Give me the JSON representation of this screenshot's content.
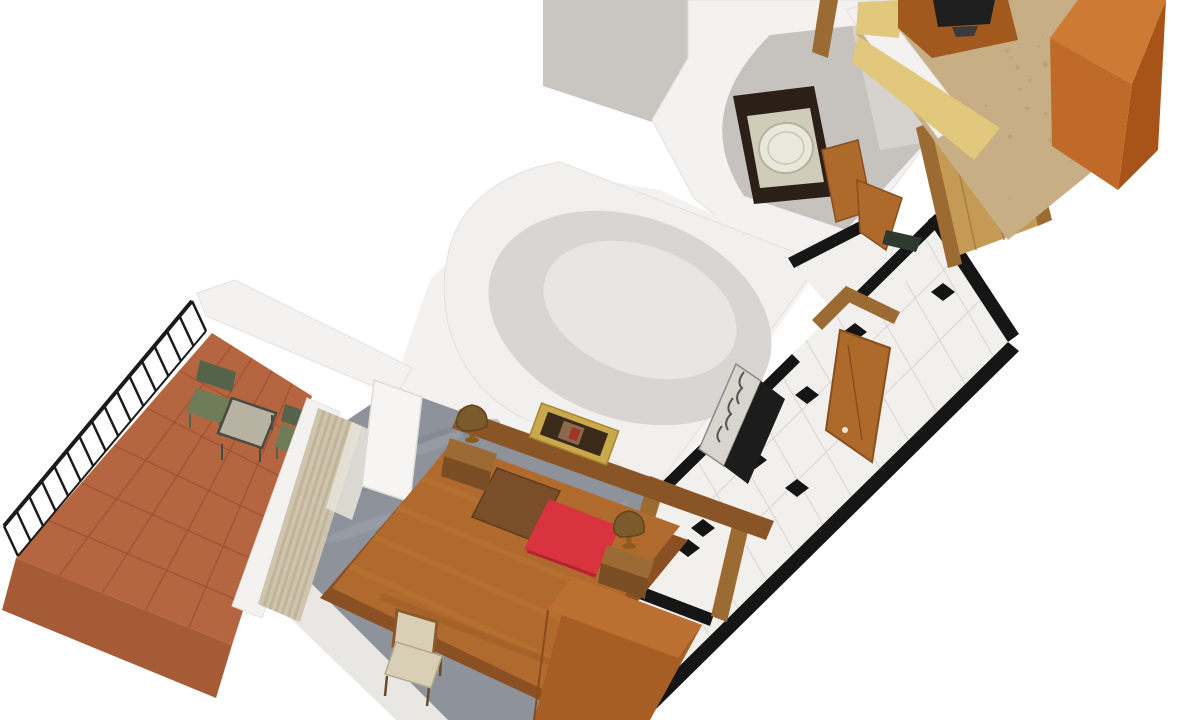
{
  "scene": {
    "kind": "3d-floorplan-render",
    "description": "Isometric 3D rendering of a hotel suite floor plan on a white background",
    "background": "#ffffff"
  },
  "palette": {
    "bg": "#ffffff",
    "roof_gray": "#c9c6c2",
    "wall_white": "#f3f2f0",
    "wall_stroke": "#e3e1de",
    "bathroom_wall": "#c6c3bf",
    "bath_wall_light": "#d6d3cf",
    "vanity_dark": "#2b1f18",
    "tub_rim": "#cfccba",
    "tub_white": "#eae8db",
    "tub_stroke": "#b5b2a2",
    "tub_inner": "#c9c6b6",
    "door_wood": "#ad6a2b",
    "door_wood_dark": "#8a4f1e",
    "frame_wood": "#9c6a33",
    "dome_outer": "#f1f0ee",
    "dome_inner": "#d8d5d2",
    "dome_inner_hi": "#e7e6e4",
    "tile_white": "#f2f0ed",
    "tile_grout": "#dcd9d5",
    "tile_black": "#141414",
    "strip_black": "#151515",
    "grille_light": "#d8d5cf",
    "grille_edge": "#8a8a86",
    "grille_squiggle": "#55554f",
    "grille_dark": "#1c1c1c",
    "closet_wood": "#c49a55",
    "closet_wood_line": "#a87f40",
    "mat_green": "#2e3a30",
    "carpet_beige": "#c7ae84",
    "carpet_speckle": "#b09671",
    "counter_yellow": "#e2c87c",
    "cabinet_wood": "#a2591e",
    "tv_dark": "#1e1e1e",
    "tv_base": "#3a3a3a",
    "wardrobe_top": "#cd7a35",
    "wardrobe_right": "#a85418",
    "wardrobe_left": "#c06a2a",
    "outer_wall_gray": "#e9e7e4",
    "bedroom_floor": "#8d929b",
    "floor_streak_light": "#a6abb3",
    "floor_streak_dark": "#7a7f88",
    "terracotta": "#b56540",
    "terracotta_grout": "#a1512f",
    "terracotta_rim": "#a55c36",
    "railing_black": "#1b1b1b",
    "chair_green": "#6e7c58",
    "chair_green_dark": "#55634a",
    "table_top": "#b8b2a2",
    "table_frame": "#4a4a42",
    "curtain": "#cfc4ae",
    "curtain_dark": "#bcae92",
    "sheer_white": "#e9e5dc",
    "white_closet": "#f6f5f3",
    "closet_stroke": "#dedcd8",
    "headboard": "#8a5526",
    "bed_base": "#8a4f22",
    "bed_cover": "#b06a2e",
    "bed_cover_light": "#c07a38",
    "bed_fold": "#9a5a24",
    "pillow_brown": "#7a4e28",
    "pillow_brown_edge": "#5f3c1e",
    "pillow_red": "#d8333f",
    "pillow_red_dark": "#b02430",
    "nightstand": "#9c6a35",
    "nightstand_dark": "#7a4e22",
    "lamp_shade": "#7b5a2c",
    "lamp_edge": "#5f4520",
    "lamp_brass": "#8a5c1e",
    "frame_gold": "#caa84e",
    "frame_gold_edge": "#a8862e",
    "frame_inner": "#3a2a1a",
    "art_bg": "#8a6a4a",
    "frame_art_red": "#a33326",
    "chair_beige": "#d8cfb6",
    "chair_seat_edge": "#b5a88a",
    "chair_back_edge": "#8a5a2a",
    "chair_leg": "#6b4a2a",
    "dresser": "#a65e24",
    "dresser_top": "#bb7031",
    "dresser_edge": "#8a4b1c"
  },
  "hallway": {
    "floor": "white tile with black diamond insets and black border strips",
    "diamonds": [
      [
        943,
        292
      ],
      [
        855,
        332
      ],
      [
        807,
        395
      ],
      [
        755,
        460
      ],
      [
        797,
        488
      ],
      [
        703,
        528
      ],
      [
        688,
        548
      ]
    ]
  },
  "details": {
    "railing_posts": 16,
    "carpet_speckles": 26,
    "floor_streaks": 18,
    "curtain_stripes": 6,
    "bed_streaks": 4,
    "corridor_grout_step": 40
  },
  "legend": {
    "rooms": [
      {
        "id": "balcony",
        "floor": "terracotta tile",
        "items": [
          "iron railing",
          "green chair",
          "green chair",
          "side table"
        ]
      },
      {
        "id": "bedroom",
        "floor": "gray marble",
        "items": [
          "double bed",
          "headboard",
          "brown pillow",
          "red pillow",
          "nightstand x2",
          "table lamp x2",
          "framed picture",
          "curtains",
          "white closet",
          "desk chair",
          "dresser"
        ]
      },
      {
        "id": "hallway",
        "floor": "white tile + black diamonds",
        "items": [
          "entry door",
          "decorative grille"
        ]
      },
      {
        "id": "bathroom",
        "floor": "gray",
        "items": [
          "curved dome wall",
          "dark vanity",
          "bathtub",
          "wood door"
        ]
      },
      {
        "id": "dressing-area",
        "floor": "light wood",
        "items": [
          "door frames",
          "open door",
          "dark mat"
        ]
      },
      {
        "id": "second-room",
        "floor": "beige carpet",
        "items": [
          "tv cabinet",
          "tv",
          "yellow counter",
          "orange wardrobe"
        ]
      }
    ]
  }
}
